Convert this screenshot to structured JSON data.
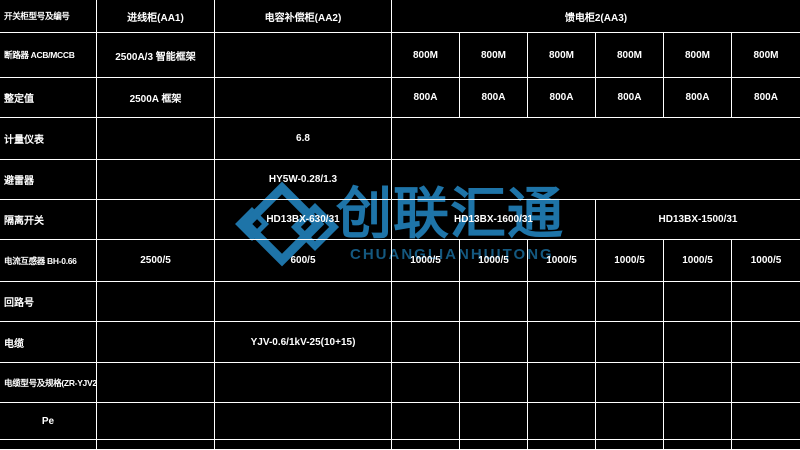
{
  "colors": {
    "background": "#000000",
    "grid_line": "#ffffff",
    "text": "#ffffff",
    "watermark_blue": "#1e74a8",
    "watermark_sub_blue": "#14587f"
  },
  "watermark": {
    "logo": "double-diamond-logo",
    "text": "创联汇通",
    "subtext": "CHUANGLIANHUITONG"
  },
  "table": {
    "columns_px": [
      97,
      118,
      177,
      68,
      68,
      68,
      68,
      68,
      68
    ],
    "rows": [
      {
        "h": 33,
        "cells": [
          {
            "c": 0,
            "t": "开关柜型号及编号",
            "a": "l",
            "f": "s"
          },
          {
            "c": 1,
            "t": "进线柜(AA1)"
          },
          {
            "c": 2,
            "t": "电容补偿柜(AA2)"
          },
          {
            "c": 3,
            "s": 6,
            "t": "馈电柜2(AA3)"
          }
        ]
      },
      {
        "h": 45,
        "cells": [
          {
            "c": 0,
            "t": "断路器 ACB/MCCB",
            "a": "l",
            "f": "s"
          },
          {
            "c": 1,
            "t": "2500A/3 智能框架"
          },
          {
            "c": 2,
            "t": ""
          },
          {
            "c": 3,
            "t": "800M"
          },
          {
            "c": 4,
            "t": "800M"
          },
          {
            "c": 5,
            "t": "800M"
          },
          {
            "c": 6,
            "t": "800M"
          },
          {
            "c": 7,
            "t": "800M"
          },
          {
            "c": 8,
            "t": "800M"
          }
        ]
      },
      {
        "h": 40,
        "cells": [
          {
            "c": 0,
            "t": "整定值",
            "a": "l"
          },
          {
            "c": 1,
            "t": "2500A 框架"
          },
          {
            "c": 2,
            "t": ""
          },
          {
            "c": 3,
            "t": "800A"
          },
          {
            "c": 4,
            "t": "800A"
          },
          {
            "c": 5,
            "t": "800A"
          },
          {
            "c": 6,
            "t": "800A"
          },
          {
            "c": 7,
            "t": "800A"
          },
          {
            "c": 8,
            "t": "800A"
          }
        ]
      },
      {
        "h": 42,
        "cells": [
          {
            "c": 0,
            "t": "计量仪表",
            "a": "l"
          },
          {
            "c": 1,
            "t": ""
          },
          {
            "c": 2,
            "t": "6.8"
          },
          {
            "c": 3,
            "s": 6,
            "t": ""
          }
        ]
      },
      {
        "h": 40,
        "cells": [
          {
            "c": 0,
            "t": "避雷器",
            "a": "l"
          },
          {
            "c": 1,
            "t": ""
          },
          {
            "c": 2,
            "t": "HY5W-0.28/1.3"
          },
          {
            "c": 3,
            "s": 6,
            "t": ""
          }
        ]
      },
      {
        "h": 40,
        "cells": [
          {
            "c": 0,
            "t": "隔离开关",
            "a": "l"
          },
          {
            "c": 1,
            "t": ""
          },
          {
            "c": 2,
            "t": "HD13BX-630/31"
          },
          {
            "c": 3,
            "s": 3,
            "t": "HD13BX-1600/31"
          },
          {
            "c": 6,
            "s": 3,
            "t": "HD13BX-1500/31"
          }
        ]
      },
      {
        "h": 42,
        "cells": [
          {
            "c": 0,
            "t": "电流互感器 BH-0.66",
            "a": "l",
            "f": "s"
          },
          {
            "c": 1,
            "t": "2500/5"
          },
          {
            "c": 2,
            "t": "600/5"
          },
          {
            "c": 3,
            "t": "1000/5"
          },
          {
            "c": 4,
            "t": "1000/5"
          },
          {
            "c": 5,
            "t": "1000/5"
          },
          {
            "c": 6,
            "t": "1000/5"
          },
          {
            "c": 7,
            "t": "1000/5"
          },
          {
            "c": 8,
            "t": "1000/5"
          }
        ]
      },
      {
        "h": 40,
        "cells": [
          {
            "c": 0,
            "t": "回路号",
            "a": "l"
          },
          {
            "c": 1,
            "t": ""
          },
          {
            "c": 2,
            "t": ""
          },
          {
            "c": 3,
            "t": ""
          },
          {
            "c": 4,
            "t": ""
          },
          {
            "c": 5,
            "t": ""
          },
          {
            "c": 6,
            "t": ""
          },
          {
            "c": 7,
            "t": ""
          },
          {
            "c": 8,
            "t": ""
          }
        ]
      },
      {
        "h": 41,
        "cells": [
          {
            "c": 0,
            "t": "电缆",
            "a": "l"
          },
          {
            "c": 1,
            "t": ""
          },
          {
            "c": 2,
            "t": "YJV-0.6/1kV-25(10+15)"
          },
          {
            "c": 3,
            "t": ""
          },
          {
            "c": 4,
            "t": ""
          },
          {
            "c": 5,
            "t": ""
          },
          {
            "c": 6,
            "t": ""
          },
          {
            "c": 7,
            "t": ""
          },
          {
            "c": 8,
            "t": ""
          }
        ]
      },
      {
        "h": 40,
        "cells": [
          {
            "c": 0,
            "t": "电缆型号及规格(ZR-YJV22)",
            "a": "l",
            "f": "s"
          },
          {
            "c": 1,
            "t": ""
          },
          {
            "c": 2,
            "t": ""
          },
          {
            "c": 3,
            "t": ""
          },
          {
            "c": 4,
            "t": ""
          },
          {
            "c": 5,
            "t": ""
          },
          {
            "c": 6,
            "t": ""
          },
          {
            "c": 7,
            "t": ""
          },
          {
            "c": 8,
            "t": ""
          }
        ]
      },
      {
        "h": 37,
        "cells": [
          {
            "c": 0,
            "t": "Pe"
          },
          {
            "c": 1,
            "t": ""
          },
          {
            "c": 2,
            "t": ""
          },
          {
            "c": 3,
            "t": ""
          },
          {
            "c": 4,
            "t": ""
          },
          {
            "c": 5,
            "t": ""
          },
          {
            "c": 6,
            "t": ""
          },
          {
            "c": 7,
            "t": ""
          },
          {
            "c": 8,
            "t": ""
          }
        ]
      },
      {
        "h": 10,
        "cells": [
          {
            "c": 0,
            "t": ""
          },
          {
            "c": 1,
            "t": ""
          },
          {
            "c": 2,
            "t": ""
          },
          {
            "c": 3,
            "t": ""
          },
          {
            "c": 4,
            "t": ""
          },
          {
            "c": 5,
            "t": ""
          },
          {
            "c": 6,
            "t": ""
          },
          {
            "c": 7,
            "t": ""
          },
          {
            "c": 8,
            "t": ""
          }
        ]
      }
    ]
  }
}
